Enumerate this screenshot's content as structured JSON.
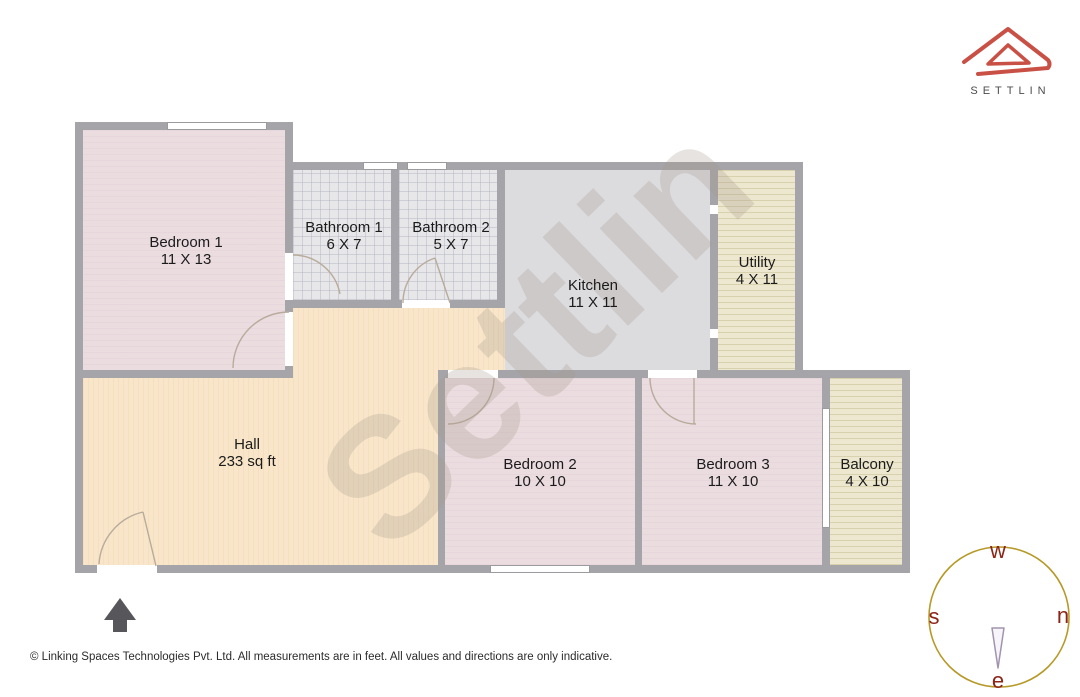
{
  "brand": {
    "name": "SETTLIN"
  },
  "watermark": {
    "text": "Settlin"
  },
  "floorplan": {
    "rooms": [
      {
        "key": "bedroom-1",
        "label": "Bedroom 1",
        "size": "11 X 13"
      },
      {
        "key": "bathroom-1",
        "label": "Bathroom 1",
        "size": "6 X 7"
      },
      {
        "key": "bathroom-2",
        "label": "Bathroom 2",
        "size": "5 X 7"
      },
      {
        "key": "kitchen",
        "label": "Kitchen",
        "size": "11 X 11"
      },
      {
        "key": "utility",
        "label": "Utility",
        "size": "4 X 11"
      },
      {
        "key": "hall",
        "label": "Hall",
        "size": "233 sq ft"
      },
      {
        "key": "bedroom-2",
        "label": "Bedroom 2",
        "size": "10 X 10"
      },
      {
        "key": "bedroom-3",
        "label": "Bedroom 3",
        "size": "11 X 10"
      },
      {
        "key": "balcony",
        "label": "Balcony",
        "size": "4 X 10"
      }
    ]
  },
  "compass": {
    "top": "w",
    "right": "n",
    "bottom": "e",
    "left": "s"
  },
  "footer": {
    "copyright": "© Linking Spaces Technologies Pvt. Ltd. All measurements are in feet. All values and directions are only indicative."
  },
  "colors": {
    "brand_red": "#c85045",
    "wall": "#a5a5a9",
    "bedroom_fill": "#ebdce0",
    "hall_fill": "#f9e6ca",
    "kitchen_fill": "#dcdcdf",
    "bathroom_fill": "#e7e7ea",
    "utility_fill": "#ece7ce",
    "compass_ring": "#b69a28",
    "compass_letter": "#8d2418"
  }
}
